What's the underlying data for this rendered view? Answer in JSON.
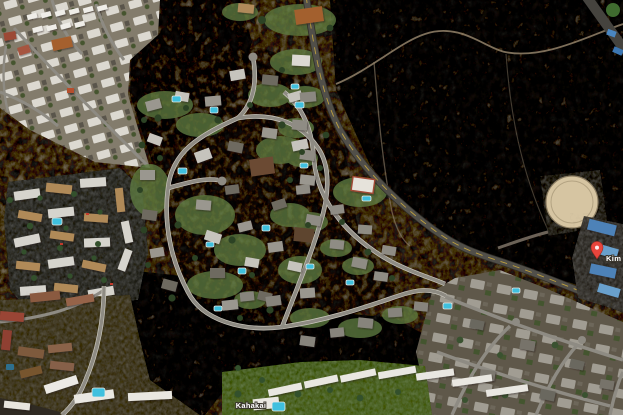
{
  "map": {
    "view_type": "satellite-imagery",
    "labels": {
      "road": "Kahakai",
      "poi_truncated": "Kim C"
    },
    "pin": {
      "type": "red-map-pin",
      "color": "#e8453c"
    },
    "palette": {
      "scrub_dark": "#3c352a",
      "field_tan": "#6a5f4c",
      "street": "#8e8b83",
      "street_curb": "#c8c5bb",
      "highway": "#514f49",
      "highway_centerline": "#c8a73e",
      "lawn": "#5e7b41",
      "tree": "#2c4224",
      "pool": "#3fc0de",
      "roof_white": "#e9e7e1",
      "roof_gray": "#8f8d88",
      "roof_tan": "#b08a58",
      "roof_red": "#9a4435",
      "water_tank": "#d6c5a2",
      "dirt_trail": "#93826a"
    }
  }
}
